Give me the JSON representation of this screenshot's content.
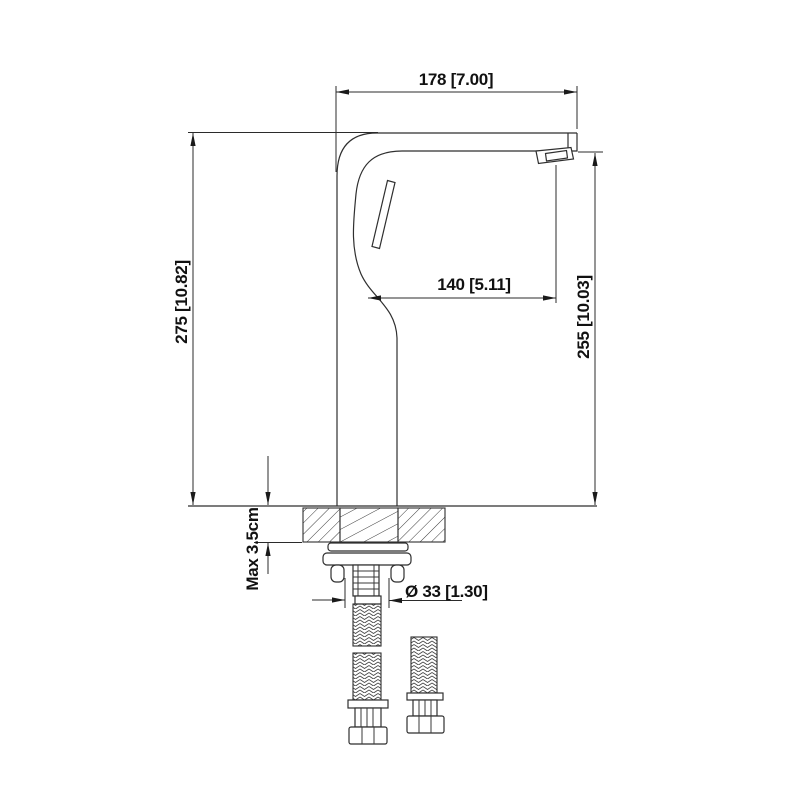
{
  "drawing": {
    "background": "#ffffff",
    "line_color": "#2f2f2f",
    "text_color": "#111111",
    "dimensions": {
      "spout_width": "178 [7.00]",
      "overall_height": "275 [10.82]",
      "spout_reach": "140 [5.11]",
      "spout_height": "255 [10.03]",
      "max_deck_thickness": "Max 3.5cm",
      "hole_diameter": "Ø 33 [1.30]"
    }
  }
}
